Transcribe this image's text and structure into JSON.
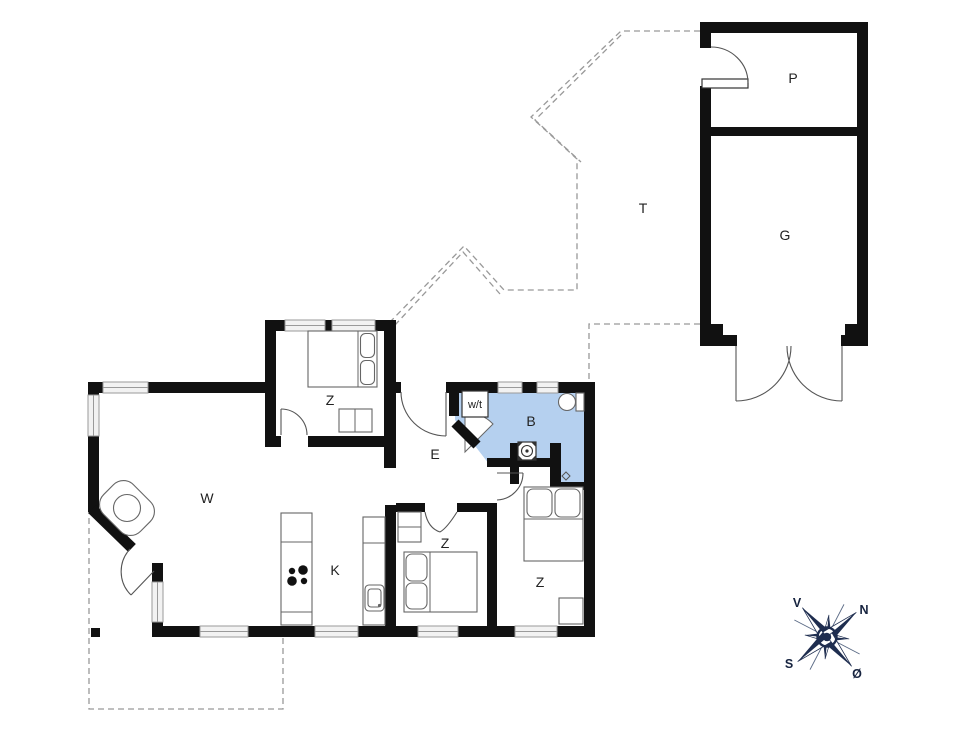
{
  "plan": {
    "labels": {
      "living": "W",
      "kitchen": "K",
      "bedroom_top": "Z",
      "bedroom_mid": "Z",
      "bedroom_right": "Z",
      "entry": "E",
      "bath": "B",
      "utility": "w/t",
      "storage": "P",
      "garage": "G",
      "terrace": "T"
    },
    "compass": {
      "west": "V",
      "north": "N",
      "south": "S",
      "east": "Ø"
    },
    "colors": {
      "wall": "#111111",
      "bath_fill": "#b5d0ef",
      "compass": "#1e2d4f",
      "dash_line": "#999999",
      "furniture_line": "#666666",
      "window_fill": "#f2f2f2"
    }
  }
}
